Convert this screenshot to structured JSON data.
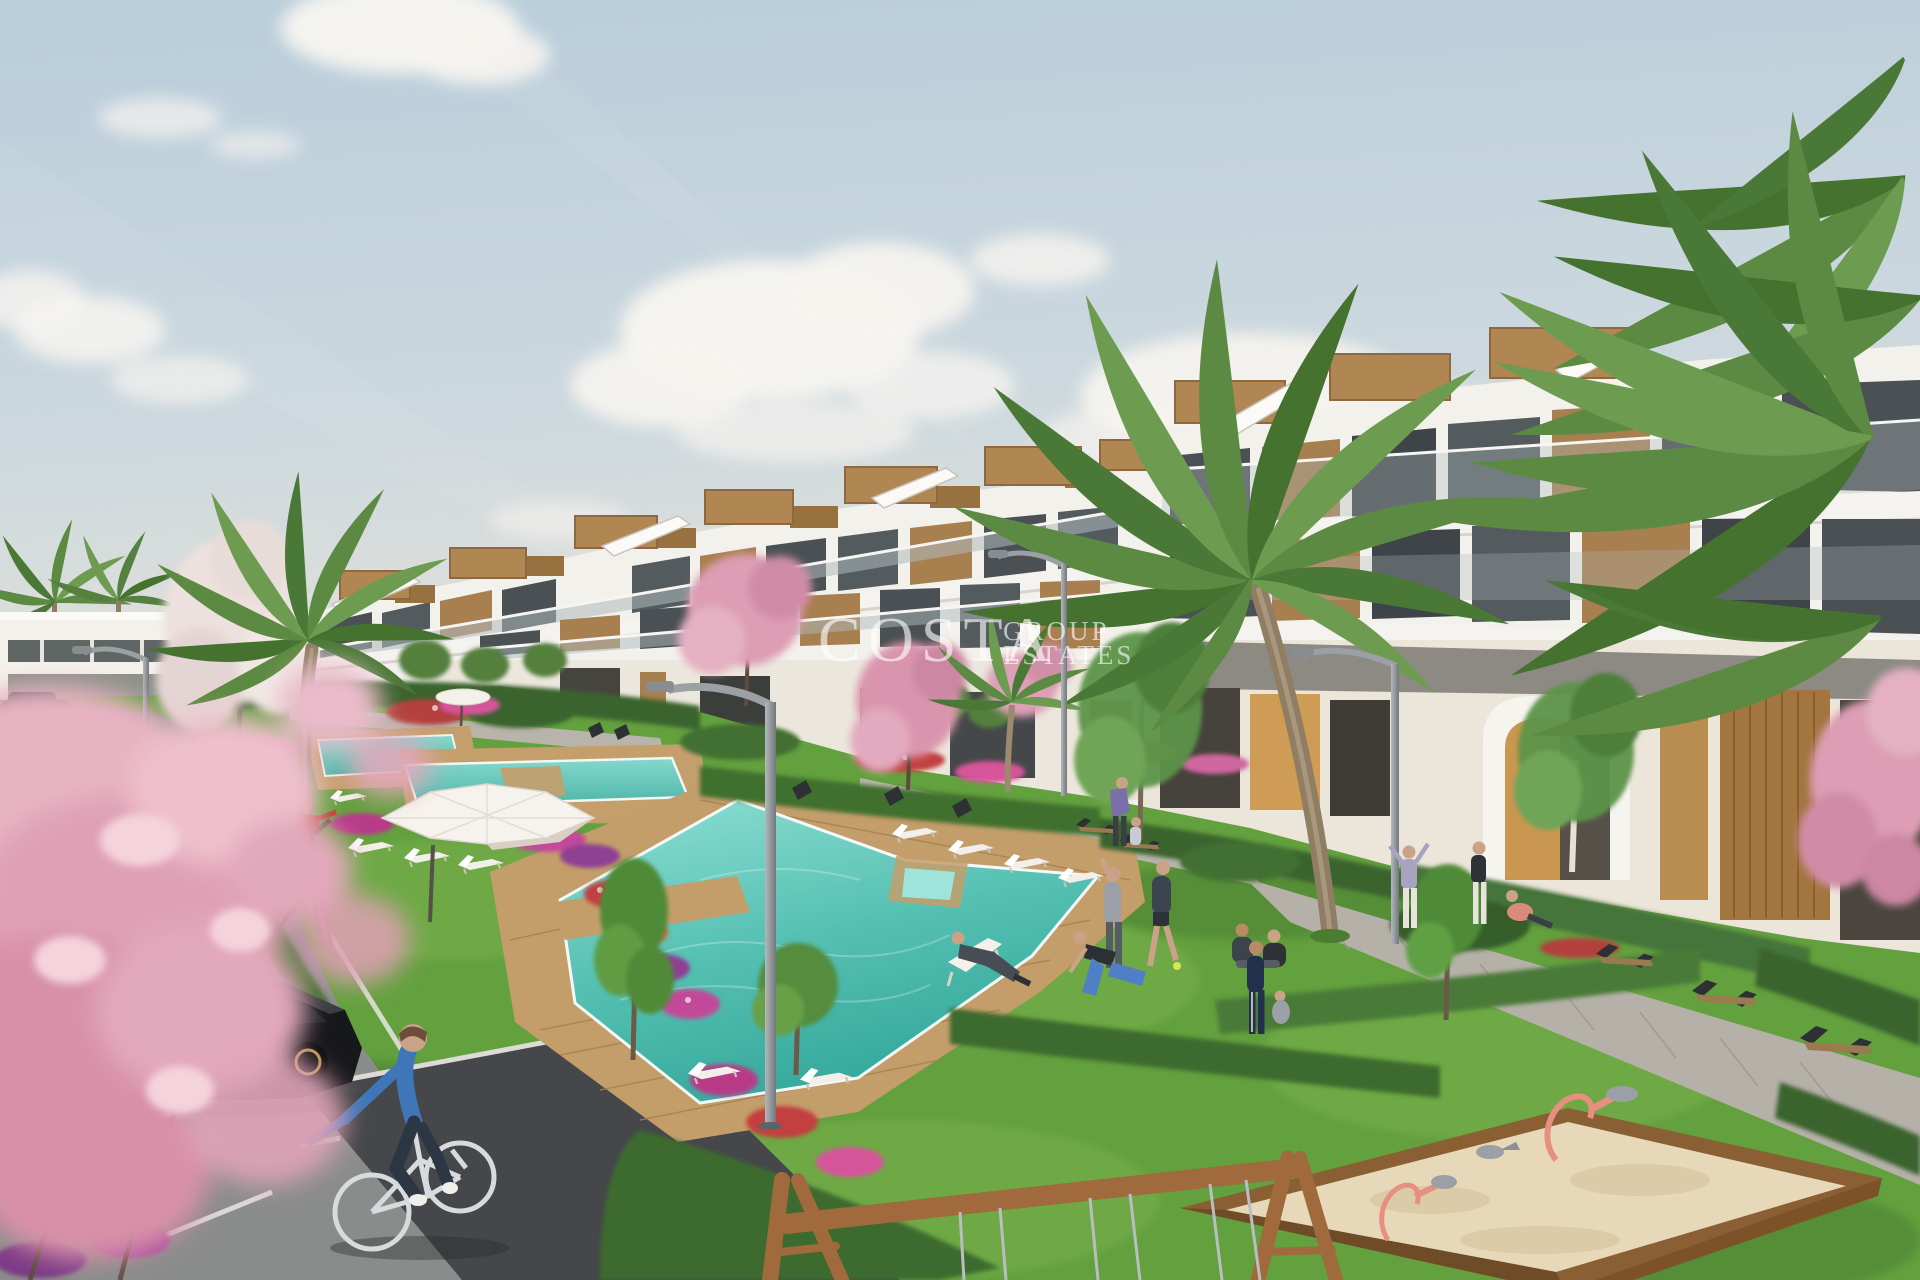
{
  "watermark": {
    "line1": "COSTA",
    "line2": "GROUP",
    "line3": "ESTATES"
  },
  "palette": {
    "sky_top": "#bccfdc",
    "sky_horizon": "#e9e2d8",
    "cloud": "#f7f4f0",
    "building_white": "#f3f1ec",
    "wood_accent": "#ab8251",
    "window_glass": "#4a5053",
    "lawn": "#63a03e",
    "hedge": "#3a642f",
    "pool_water": "#55c0b2",
    "deck_wood": "#c49e6a",
    "sand": "#e7d8b9",
    "asphalt": "#8a8c8b",
    "road_dark": "#45474a",
    "path_light": "#b7b2a9",
    "blossom_pink": "#e2a8bb",
    "playground_wood": "#a06a3c",
    "toy_coral": "#e8907f",
    "cyclist_blue": "#3f76b8",
    "sedan_blue": "#3c4a58",
    "car_black": "#17181b"
  },
  "scene": {
    "description": "Architectural render of a white terraced apartment complex with garden, pools, palms, parking and playground",
    "elements": [
      "sky",
      "clouds",
      "terraced-apartments",
      "rooftop-wood-boxes",
      "roof-stairs",
      "distant-building",
      "palm-trees",
      "pink-blossom-trees",
      "white-blossom-tree",
      "lawn",
      "hedges",
      "flower-beds",
      "upper-pools",
      "main-pool",
      "wood-deck",
      "sun-loungers",
      "parasols",
      "street-lamps",
      "benches",
      "parking-lot",
      "road",
      "sedan-car",
      "black-hatchback",
      "cyclist",
      "walking-people",
      "exercising-people",
      "sandbox",
      "spring-riders",
      "swing-frame",
      "watermark"
    ]
  }
}
